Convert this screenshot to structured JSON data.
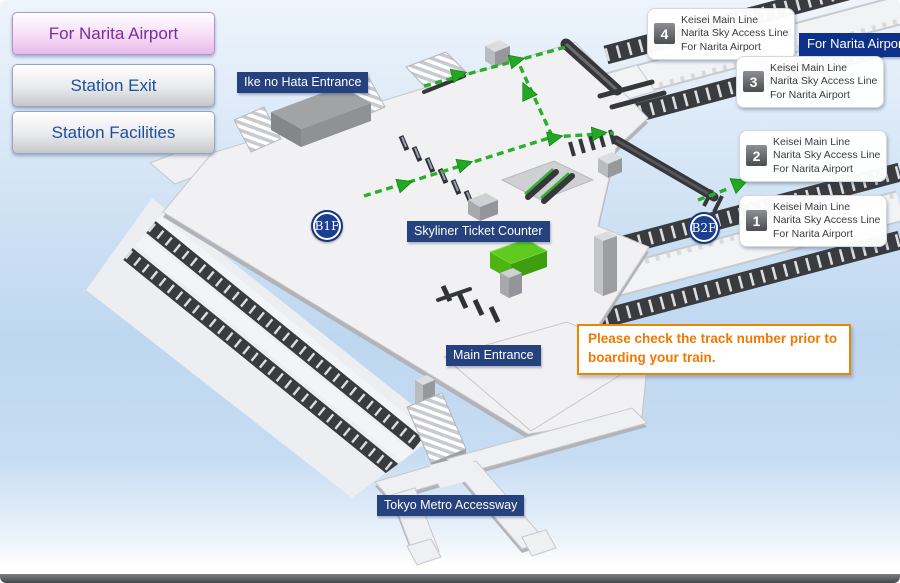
{
  "sidebar": {
    "buttons": [
      {
        "label": "For Narita Airport",
        "active": true
      },
      {
        "label": "Station Exit",
        "active": false
      },
      {
        "label": "Station Facilities",
        "active": false
      }
    ]
  },
  "map": {
    "badges": [
      {
        "label": "B1F"
      },
      {
        "label": "B2F"
      }
    ],
    "labels": {
      "ike_no_hata": "Ike no Hata Entrance",
      "skyliner_counter": "Skyliner Ticket Counter",
      "main_entrance": "Main Entrance",
      "tokyo_metro": "Tokyo Metro Accessway",
      "for_narita": "For Narita Airport"
    },
    "track_cards": [
      {
        "number": "4",
        "lines": [
          "Keisei Main Line",
          "Narita Sky Access Line",
          "For Narita Airport"
        ]
      },
      {
        "number": "3",
        "lines": [
          "Keisei Main Line",
          "Narita Sky Access Line",
          "For Narita Airport"
        ]
      },
      {
        "number": "2",
        "lines": [
          "Keisei Main Line",
          "Narita Sky Access Line",
          "For Narita Airport"
        ]
      },
      {
        "number": "1",
        "lines": [
          "Keisei Main Line",
          "Narita Sky Access Line",
          "For Narita Airport"
        ]
      }
    ],
    "notice": "Please check the track number prior to boarding your train.",
    "colors": {
      "route_green": "#28b028",
      "counter_green": "#55c514",
      "label_navy": "#25417e",
      "direction_navy": "#0d3189",
      "notice_orange": "#f08300",
      "active_button_purple": "#7b2da0",
      "badge_navy": "#1c3f90"
    },
    "icons": {
      "route_arrow": "route-arrow-icon",
      "stairs": "stairs-icon",
      "escalator": "escalator-icon",
      "elevator": "elevator-box-icon"
    }
  }
}
